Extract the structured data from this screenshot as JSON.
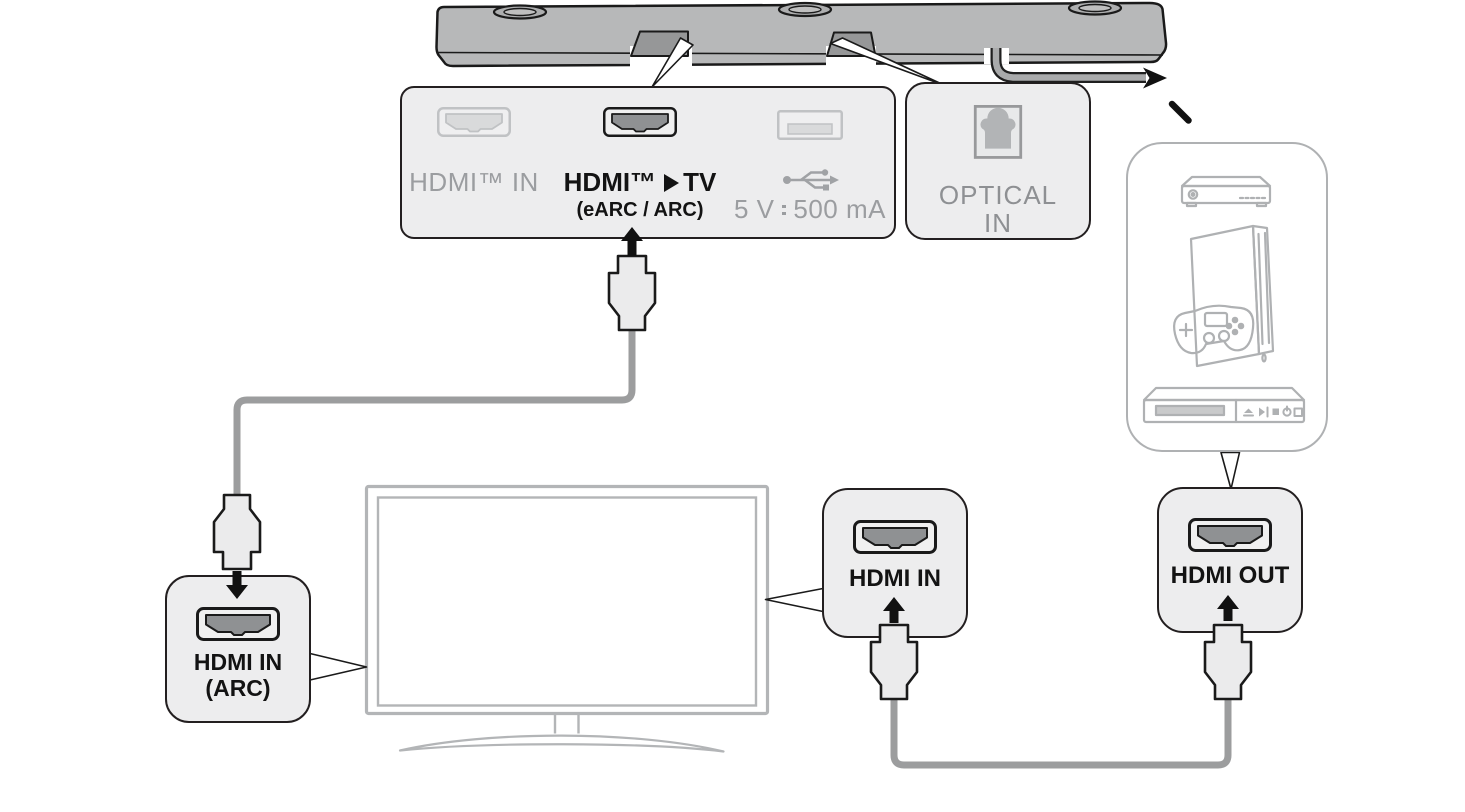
{
  "diagram": {
    "soundbar_ports_panel": {
      "hdmi_in_label": "HDMI™ IN",
      "hdmi_tv_label_prefix": "HDMI™",
      "hdmi_tv_label_suffix": "TV",
      "hdmi_tv_sublabel": "(eARC / ARC)",
      "usb_rating_left": "5 V",
      "usb_rating_right": "500 mA"
    },
    "optical_in_panel": {
      "label_line1": "OPTICAL",
      "label_line2": "IN"
    },
    "tv_hdmi_arc_panel": {
      "label_line1": "HDMI IN",
      "label_line2": "(ARC)"
    },
    "tv_hdmi_in_panel": {
      "label": "HDMI IN"
    },
    "source_hdmi_out_panel": {
      "label": "HDMI OUT"
    },
    "icons": {
      "usb_symbol": "usb-trident-icon",
      "dc_power": "direct-current-icon",
      "hdmi_to_tv_arrow": "right-triangle-icon",
      "optical_port": "optical-port-icon",
      "hdmi_port": "hdmi-port-icon",
      "usb_port": "usb-port-icon",
      "soundbar": "soundbar-icon",
      "tv": "tv-icon",
      "source_devices": [
        "set-top-box-icon",
        "game-console-icon",
        "disc-player-icon"
      ]
    },
    "colors": {
      "panel_fill": "#EDEDEE",
      "panel_border": "#231F20",
      "muted_text": "#9B9DA0",
      "optical_text": "#8E9093",
      "dark_text": "#131313",
      "cable_gray": "#9C9D9E",
      "device_outline": "#AFB1B3",
      "tv_outline": "#B3B5B7",
      "soundbar_fill": "#B7B8B9",
      "arrow_black": "#111111"
    }
  }
}
